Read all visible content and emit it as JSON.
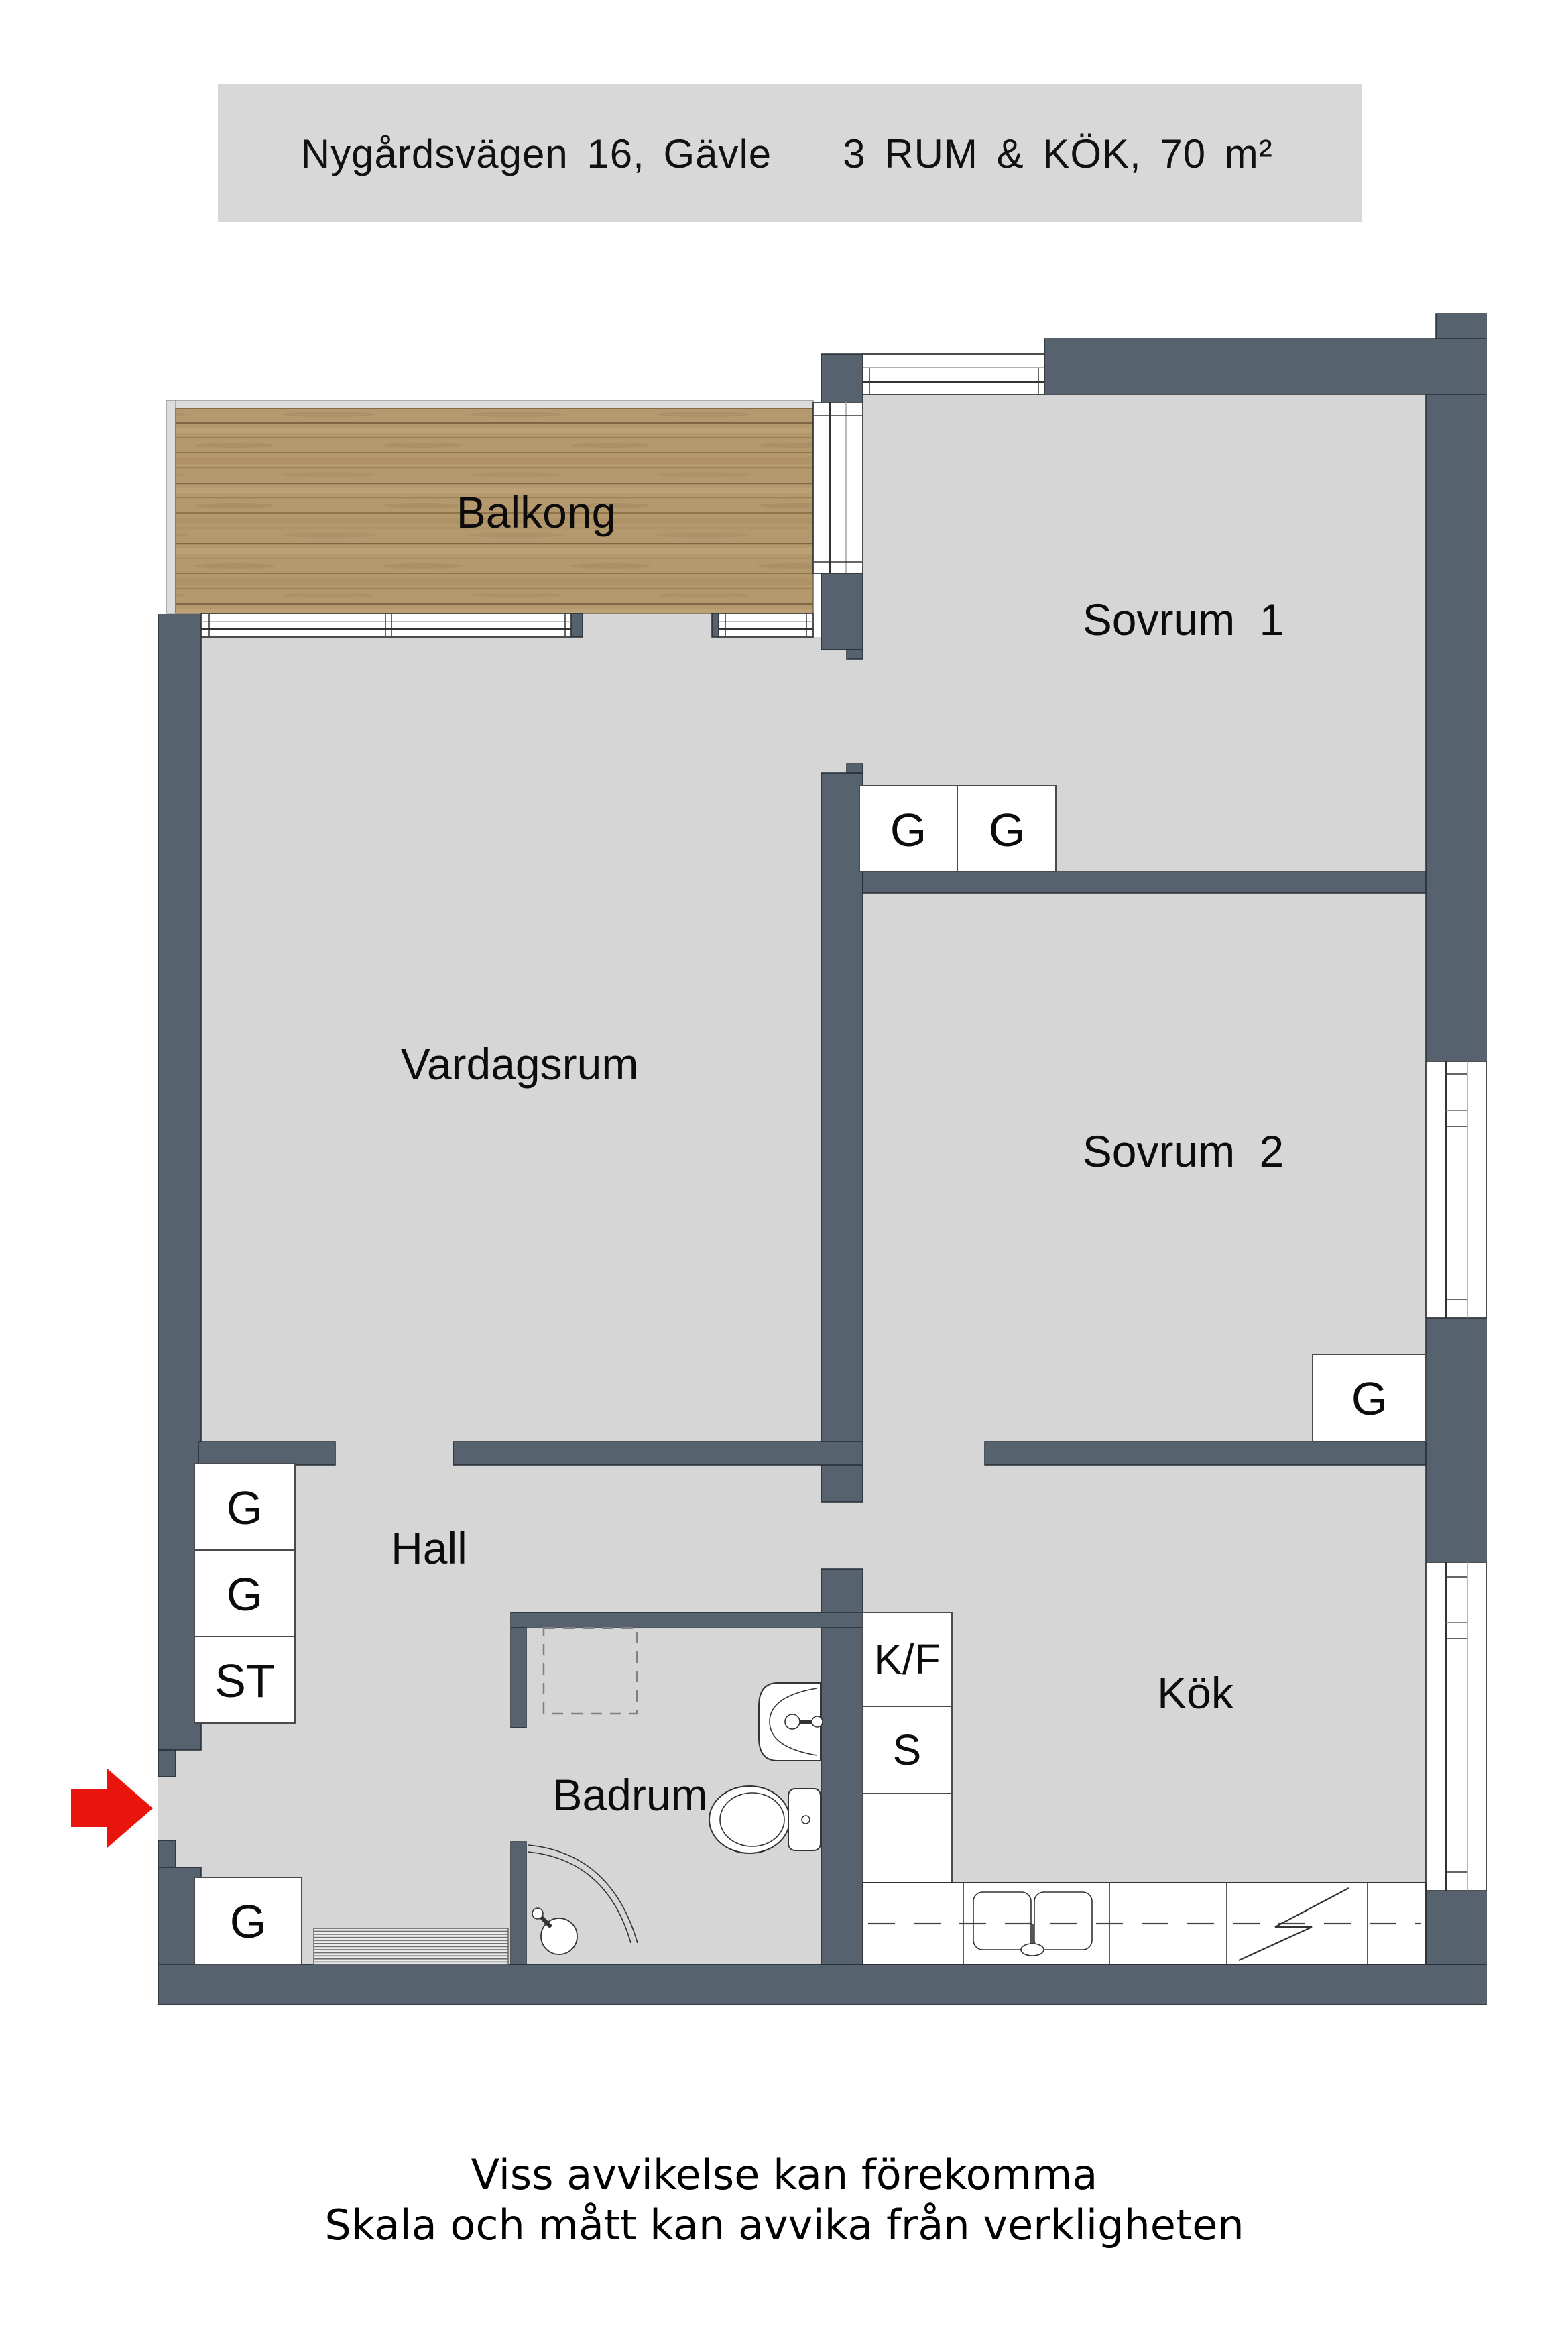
{
  "header": {
    "address": "Nygårdsvägen 16, Gävle",
    "specs": "3 RUM & KÖK, 70 m²"
  },
  "rooms": {
    "balkong": {
      "label": "Balkong"
    },
    "sovrum1": {
      "label": "Sovrum 1"
    },
    "vardagsrum": {
      "label": "Vardagsrum"
    },
    "sovrum2": {
      "label": "Sovrum 2"
    },
    "hall": {
      "label": "Hall"
    },
    "badrum": {
      "label": "Badrum"
    },
    "kok": {
      "label": "Kök"
    }
  },
  "storage": {
    "sovrum1_g1": "G",
    "sovrum1_g2": "G",
    "sovrum2_g": "G",
    "hall_g1": "G",
    "hall_g2": "G",
    "hall_st": "ST",
    "entry_g": "G"
  },
  "kitchen": {
    "fridge_freezer": "K/F",
    "pantry": "S"
  },
  "footer": {
    "line1": "Viss avvikelse kan förekomma",
    "line2": "Skala och mått kan avvika från verkligheten"
  },
  "colors": {
    "wall": "#56626e",
    "floor": "#d6d6d6",
    "balcony_wood": "#b5996e",
    "title_panel": "#d8d8d8",
    "entry_arrow_red": "#e9150d"
  }
}
